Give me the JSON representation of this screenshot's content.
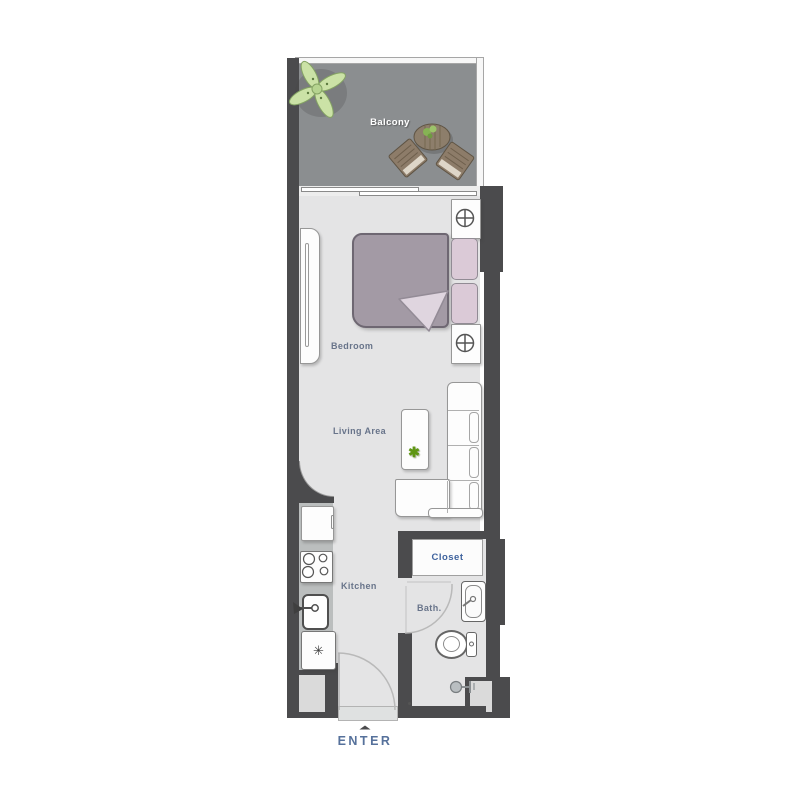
{
  "rooms": {
    "balcony": "Balcony",
    "bedroom": "Bedroom",
    "living_area": "Living Area",
    "kitchen": "Kitchen",
    "closet": "Closet",
    "bath": "Bath."
  },
  "entrance": {
    "label": "ENTER",
    "arrow_glyph": "▲"
  },
  "glyphs": {
    "fridge_snowflake": "✳",
    "table_plant": "✱"
  },
  "colors": {
    "wall": "#4b4b4d",
    "floor": "#e4e4e5",
    "balcony_floor": "#8b8e90",
    "kitchen_counter": "#bbbebe",
    "room_label": "#68748a",
    "closet_label": "#3f639e",
    "enter_label": "#56719b",
    "balcony_label": "#ffffff",
    "bed_blanket": "#a39aa5",
    "pillow": "#dbcad7",
    "balcony_wood": "#8d7c69",
    "plant_green": "#cfe5ab"
  }
}
